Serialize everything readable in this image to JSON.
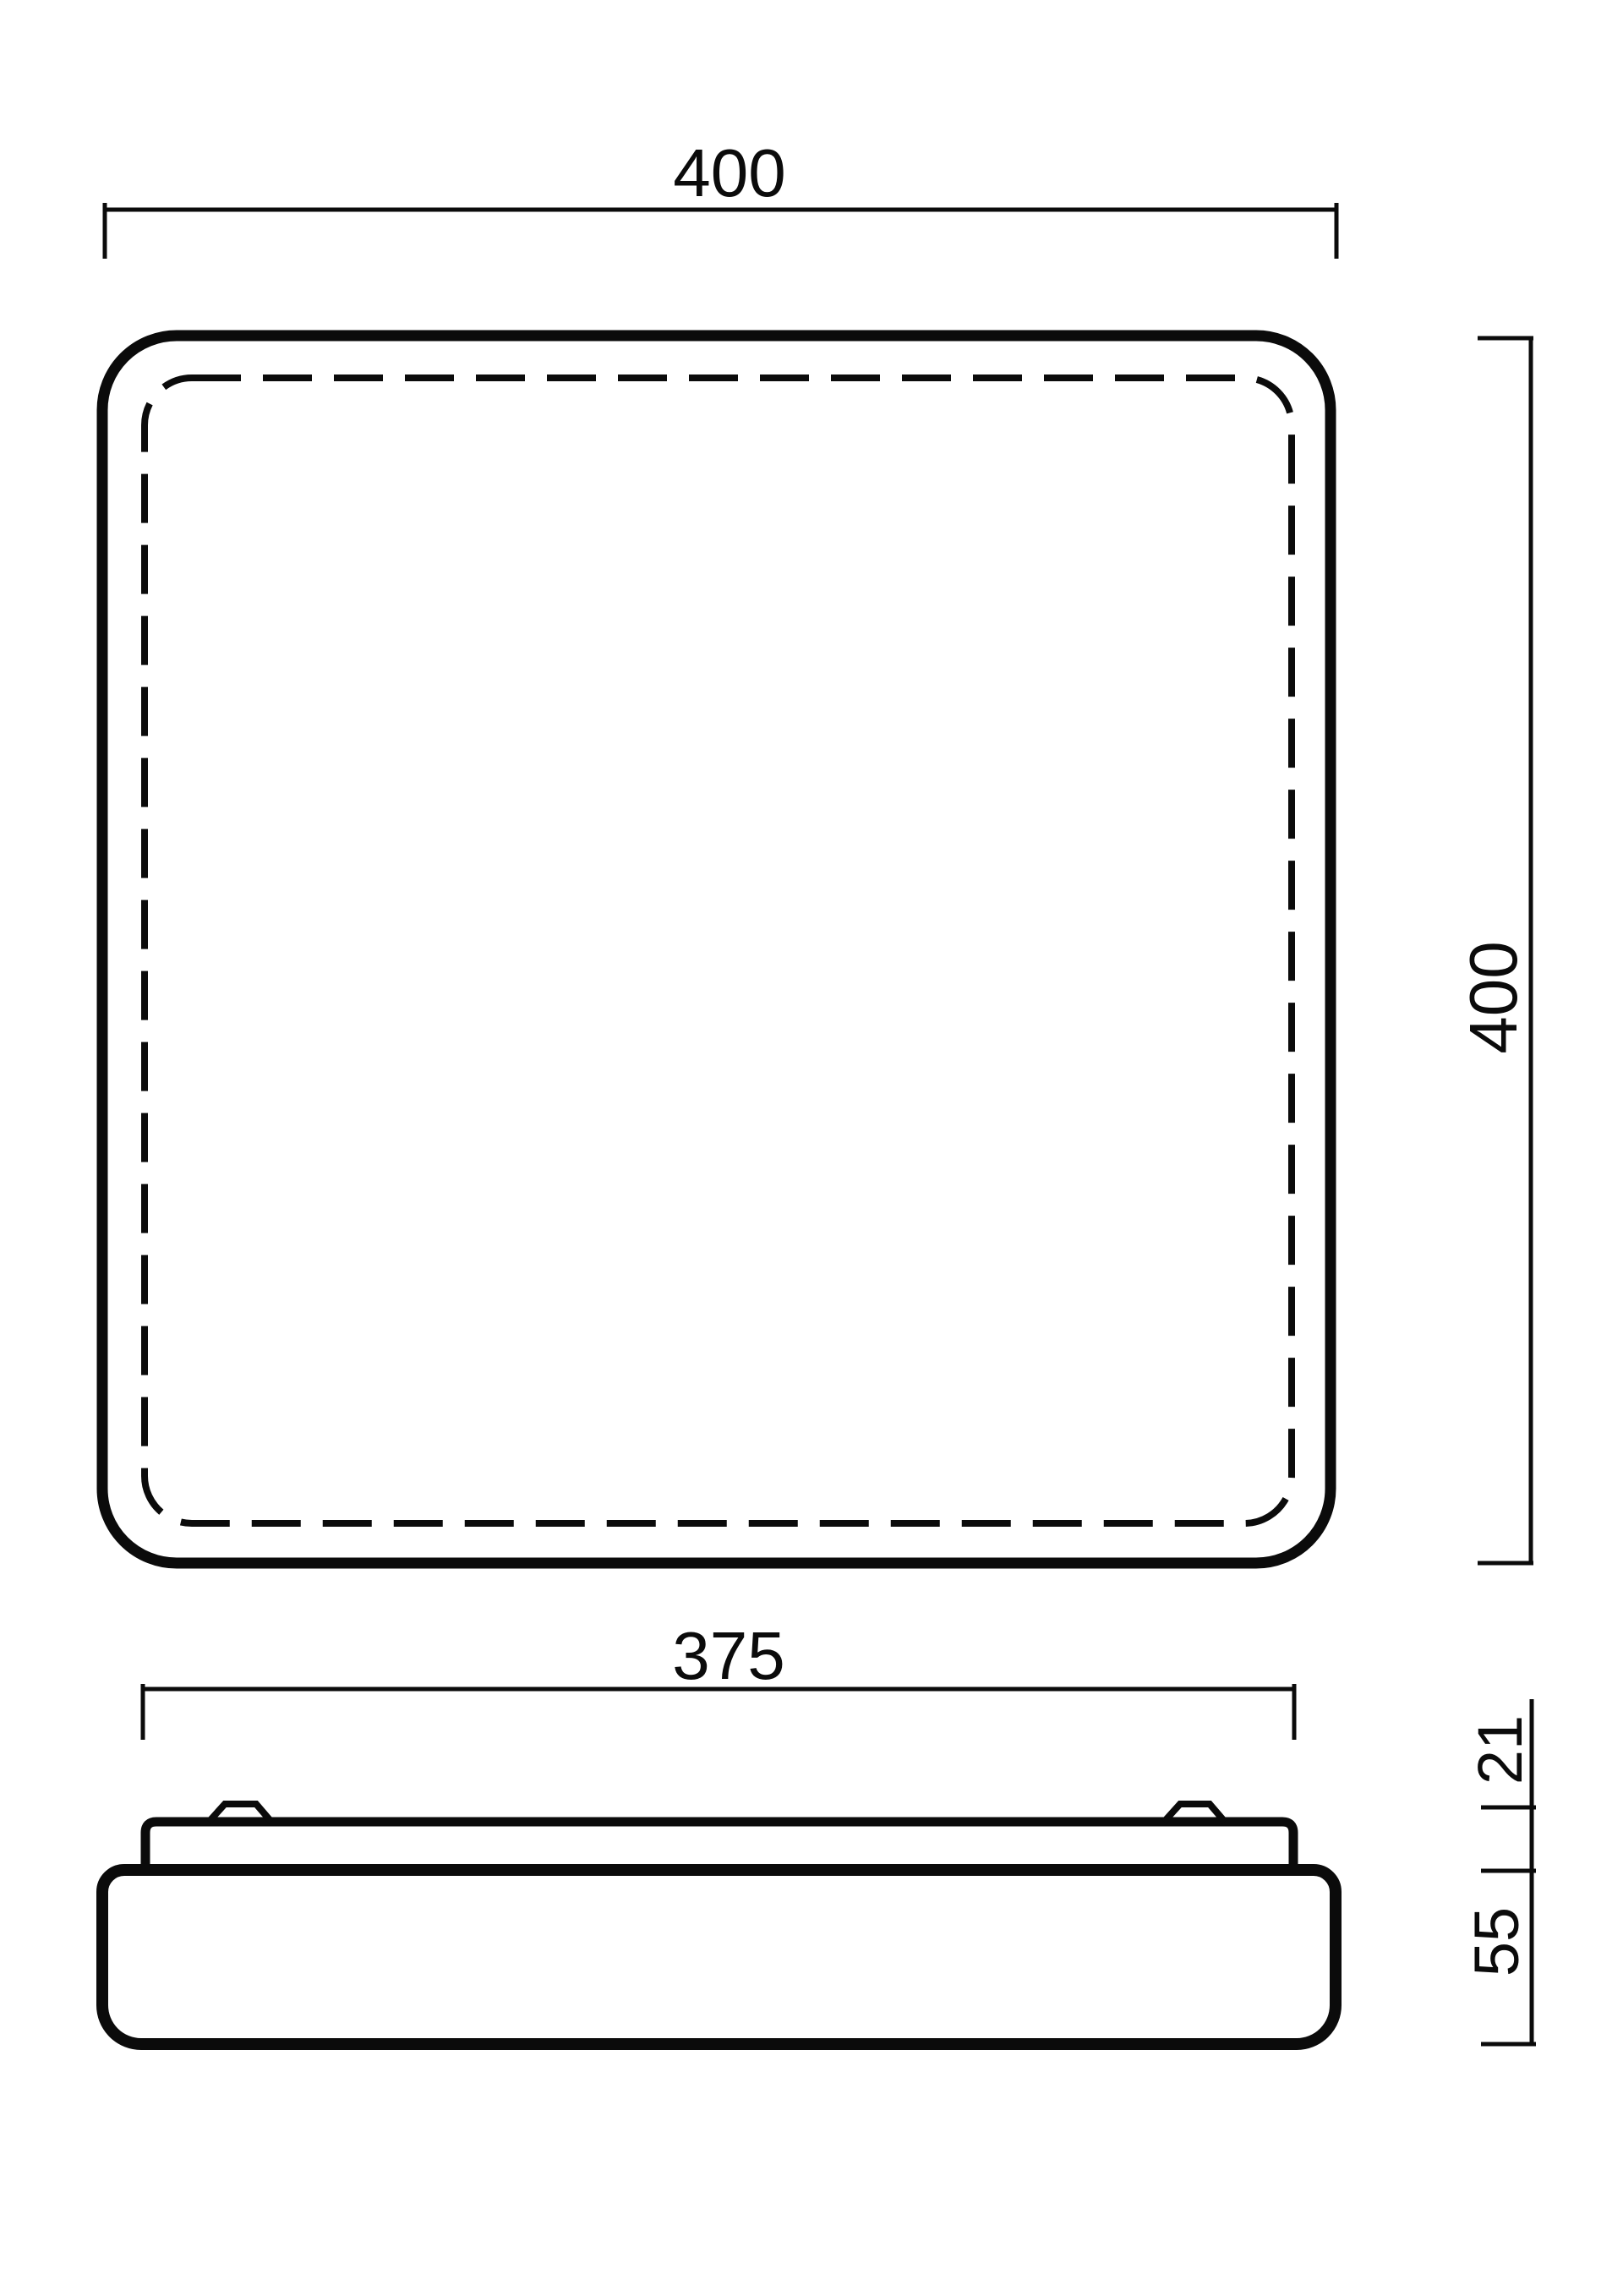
{
  "drawing": {
    "background": "#ffffff",
    "stroke_color": "#0b0b0b",
    "views": {
      "top_view": "plan view of square luminaire with dashed diffuser outline",
      "side_view": "profile view with mounting base plate and two clips"
    },
    "dimensions": {
      "top_view_width": "400",
      "top_view_height": "400",
      "side_view_base_width": "375",
      "side_view_top_height": "21",
      "side_view_body_height": "55"
    }
  }
}
